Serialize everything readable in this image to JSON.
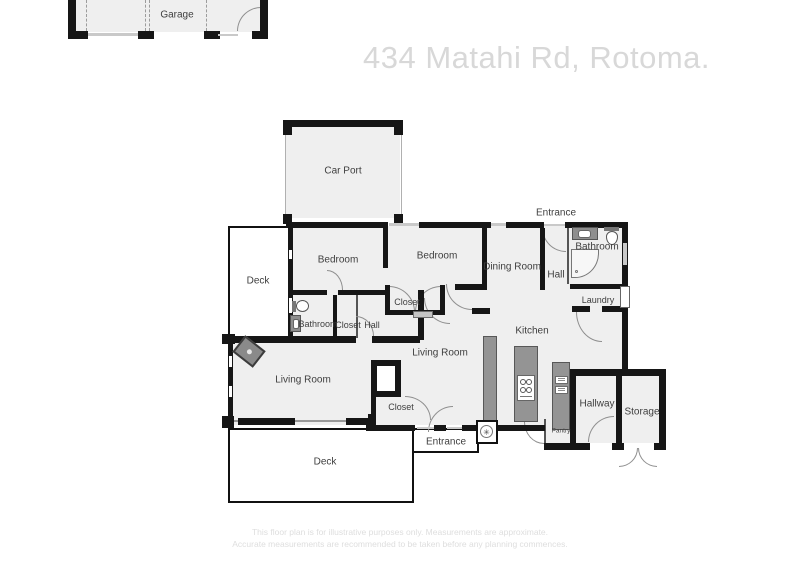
{
  "title": "434 Matahi Rd, Rotoma.",
  "disclaimer": {
    "line1": "This floor plan is for illustrative purposes only. Measurements are approximate.",
    "line2": "Accurate measurements are recommended to be taken before any planning commences."
  },
  "rooms": {
    "garage": "Garage",
    "car_port": "Car Port",
    "entrance_top": "Entrance",
    "bathroom_top": "Bathroom",
    "bedroom_left": "Bedroom",
    "bedroom_mid": "Bedroom",
    "dining_room": "Dining Room",
    "hall_top": "Hall",
    "deck_top": "Deck",
    "closet_mid": "Closet",
    "laundry": "Laundry",
    "bathroom_left": "Bathroom",
    "closet_left": "Closet",
    "hall_left": "Hall",
    "kitchen": "Kitchen",
    "living_room_center": "Living Room",
    "living_room_left": "Living Room",
    "closet_bottom": "Closet",
    "hallway": "Hallway",
    "storage": "Storage",
    "pantry": "Pantry",
    "entrance_bottom": "Entrance",
    "deck_bottom": "Deck"
  },
  "icons": {
    "hot_water_cylinder_fan": "✳"
  },
  "colors": {
    "wall": "#161616",
    "room_fill": "#efefef",
    "deck_fill": "#ffffff",
    "counter": "#949494",
    "window": "#c9c9c9",
    "title_text": "#d8d8d8",
    "label_text": "#3e3e3e",
    "disclaimer_text": "#dedede"
  }
}
